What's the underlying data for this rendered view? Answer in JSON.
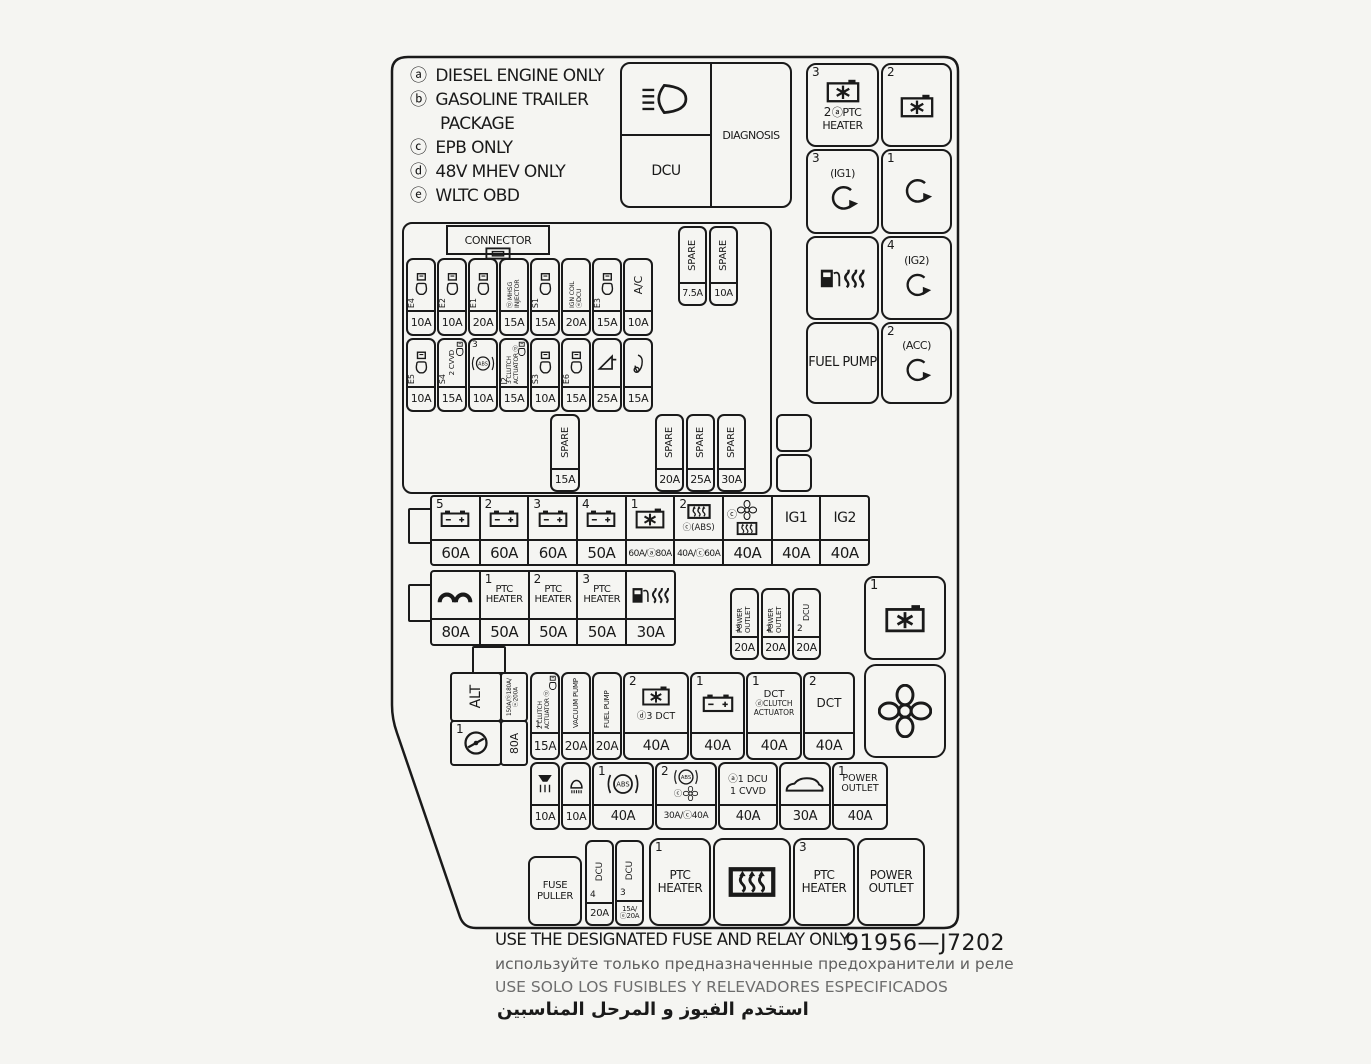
{
  "colors": {
    "bg": "#f5f5f2",
    "ink": "#1a1a1a",
    "muted": "#646464"
  },
  "legend": {
    "rows": [
      {
        "k": "ⓐ",
        "t": "DIESEL ENGINE ONLY"
      },
      {
        "k": "ⓑ",
        "t": "GASOLINE TRAILER"
      },
      {
        "k": "",
        "t": "PACKAGE"
      },
      {
        "k": "ⓒ",
        "t": "EPB ONLY"
      },
      {
        "k": "ⓓ",
        "t": "48V MHEV ONLY"
      },
      {
        "k": "ⓔ",
        "t": "WLTC OBD"
      }
    ]
  },
  "diagnosis_box": {
    "dcu": "DCU",
    "diagnosis": "DIAGNOSIS",
    "icon": "high-beam-headlight"
  },
  "relays_top": {
    "r1c1": {
      "num": "3",
      "num2": "2",
      "label": "ⓐPTC HEATER",
      "icon": "radiator-fan-relay"
    },
    "r1c2": {
      "num": "2",
      "icon": "radiator-fan-relay"
    },
    "r2c1": {
      "num": "3",
      "label": "(IG1)",
      "icon": "circular-arrow"
    },
    "r2c2": {
      "num": "1",
      "icon": "circular-arrow"
    },
    "r3c1": {
      "icon": "fuel-pump-heater"
    },
    "r3c2": {
      "num": "4",
      "label": "(IG2)",
      "icon": "circular-arrow"
    },
    "r4c1": {
      "label": "FUEL PUMP"
    },
    "r4c2": {
      "num": "2",
      "label": "(ACC)",
      "icon": "circular-arrow"
    }
  },
  "connector_label": "CONNECTOR",
  "spares_top": [
    {
      "label": "SPARE",
      "amp": "7.5A"
    },
    {
      "label": "SPARE",
      "amp": "10A"
    }
  ],
  "row_a": [
    {
      "tag": "E4",
      "amp": "10A",
      "icon": "injector"
    },
    {
      "tag": "E2",
      "amp": "10A",
      "icon": "injector"
    },
    {
      "tag": "E1",
      "amp": "20A",
      "icon": "injector"
    },
    {
      "label": "ⓓ MHSG INJECTOR",
      "amp": "15A"
    },
    {
      "tag": "S1",
      "amp": "15A",
      "icon": "injector"
    },
    {
      "label": "IGN COIL ⓐDCU",
      "amp": "20A"
    },
    {
      "tag": "E3",
      "amp": "15A",
      "icon": "injector"
    },
    {
      "label": "A/C",
      "amp": "10A"
    }
  ],
  "row_b": [
    {
      "tag": "E5",
      "amp": "10A",
      "icon": "injector"
    },
    {
      "tag": "S4",
      "label": "2 CVVD",
      "amp": "15A",
      "icon": "injector"
    },
    {
      "num": "3",
      "label": "(ABS)",
      "amp": "10A",
      "icon": "abs"
    },
    {
      "tag": "I2",
      "label": "3 CLUTCH ACTUATOR ⓓ",
      "amp": "15A",
      "icon": "injector"
    },
    {
      "tag": "S3",
      "amp": "10A",
      "icon": "injector"
    },
    {
      "tag": "E6",
      "amp": "15A",
      "icon": "injector"
    },
    {
      "amp": "25A",
      "icon": "horn"
    },
    {
      "amp": "15A",
      "icon": "trumpet-horn"
    }
  ],
  "spare_mid": {
    "label": "SPARE",
    "amp": "15A"
  },
  "spares_right": [
    {
      "label": "SPARE",
      "amp": "20A"
    },
    {
      "label": "SPARE",
      "amp": "25A"
    },
    {
      "label": "SPARE",
      "amp": "30A"
    }
  ],
  "big_row": [
    {
      "num": "5",
      "amp": "60A",
      "icon": "battery"
    },
    {
      "num": "2",
      "amp": "60A",
      "icon": "battery"
    },
    {
      "num": "3",
      "amp": "60A",
      "icon": "battery"
    },
    {
      "num": "4",
      "amp": "50A",
      "icon": "battery"
    },
    {
      "num": "1",
      "amp": "60A/ⓐ80A",
      "icon": "radiator-fan-relay"
    },
    {
      "num": "2",
      "label": "ⓒ(ABS)",
      "amp": "40A/ⓒ60A",
      "icon": "defroster"
    },
    {
      "label": "ⓒ",
      "amp": "40A",
      "icon": "cooling-fan"
    },
    {
      "label": "IG1",
      "amp": "40A"
    },
    {
      "label": "IG2",
      "amp": "40A"
    }
  ],
  "ptc_row": [
    {
      "amp": "80A",
      "icon": "glow-plug"
    },
    {
      "num": "1",
      "label": "PTC HEATER",
      "amp": "50A"
    },
    {
      "num": "2",
      "label": "PTC HEATER",
      "amp": "50A"
    },
    {
      "num": "3",
      "label": "PTC HEATER",
      "amp": "50A"
    },
    {
      "amp": "30A",
      "icon": "fuel-pump-heater"
    }
  ],
  "outlet_fuses": [
    {
      "num": "3",
      "label": "POWER OUTLET",
      "amp": "20A"
    },
    {
      "num": "2",
      "label": "POWER OUTLET",
      "amp": "20A"
    },
    {
      "num": "2",
      "label": "DCU",
      "amp": "20A"
    }
  ],
  "fan_relay": {
    "num": "1",
    "icon": "radiator-fan-relay"
  },
  "fan_box": {
    "icon": "cooling-fan"
  },
  "alt": {
    "label": "ALT",
    "rating": "150A/ⓓ180A/ⓔ200A",
    "num": "1",
    "amp": "80A",
    "icon": "steering-circle"
  },
  "dct_row": [
    {
      "num": "1",
      "label": "2 CLUTCH ACTUATOR ⓓ",
      "amp": "15A",
      "icon": "injector"
    },
    {
      "label": "VACUUM PUMP",
      "amp": "20A"
    },
    {
      "label": "FUEL PUMP",
      "amp": "20A"
    },
    {
      "num": "2",
      "label": "ⓓ3 DCT",
      "amp": "40A",
      "icon": "radiator-fan-relay"
    },
    {
      "num": "1",
      "amp": "40A",
      "icon": "battery"
    },
    {
      "num": "1",
      "label": "DCT",
      "label2": "ⓓCLUTCH ACTUATOR",
      "amp": "40A"
    },
    {
      "num": "2",
      "label": "DCT",
      "amp": "40A"
    }
  ],
  "small_row": [
    {
      "amp": "10A",
      "icon": "washer-nozzle-heater"
    },
    {
      "amp": "10A",
      "icon": "lamp"
    },
    {
      "num": "1",
      "label": "(ABS)",
      "amp": "40A",
      "icon": "abs"
    },
    {
      "num": "2",
      "label": "(ABS)",
      "label2": "ⓒ",
      "amp": "30A/ⓒ40A",
      "icon": "abs-fan"
    },
    {
      "label": "ⓐ1 DCU",
      "label2": "1 CVVD",
      "amp": "40A"
    },
    {
      "amp": "30A",
      "icon": "vehicle"
    },
    {
      "num": "1",
      "label": "POWER OUTLET",
      "amp": "40A"
    }
  ],
  "bottom_row": {
    "fuse_puller": "FUSE PULLER",
    "dcu4": {
      "num": "4",
      "label": "DCU",
      "amp": "20A"
    },
    "dcu3": {
      "num": "3",
      "label": "DCU",
      "amp": "15A/ⓔ20A"
    },
    "ptc1": {
      "num": "1",
      "label": "PTC HEATER"
    },
    "defrost": {
      "icon": "rear-defroster"
    },
    "ptc3": {
      "num": "3",
      "label": "PTC HEATER"
    },
    "outlet": {
      "label": "POWER OUTLET"
    }
  },
  "footer": {
    "en": "USE THE DESIGNATED FUSE AND RELAY ONLY",
    "part": "91956—J7202",
    "ru": "используйте только предназначенные предохранители и реле",
    "es": "USE SOLO LOS FUSIBLES Y RELEVADORES ESPECIFICADOS",
    "ar": "استخدم الفيوز و المرحل المناسبين"
  }
}
